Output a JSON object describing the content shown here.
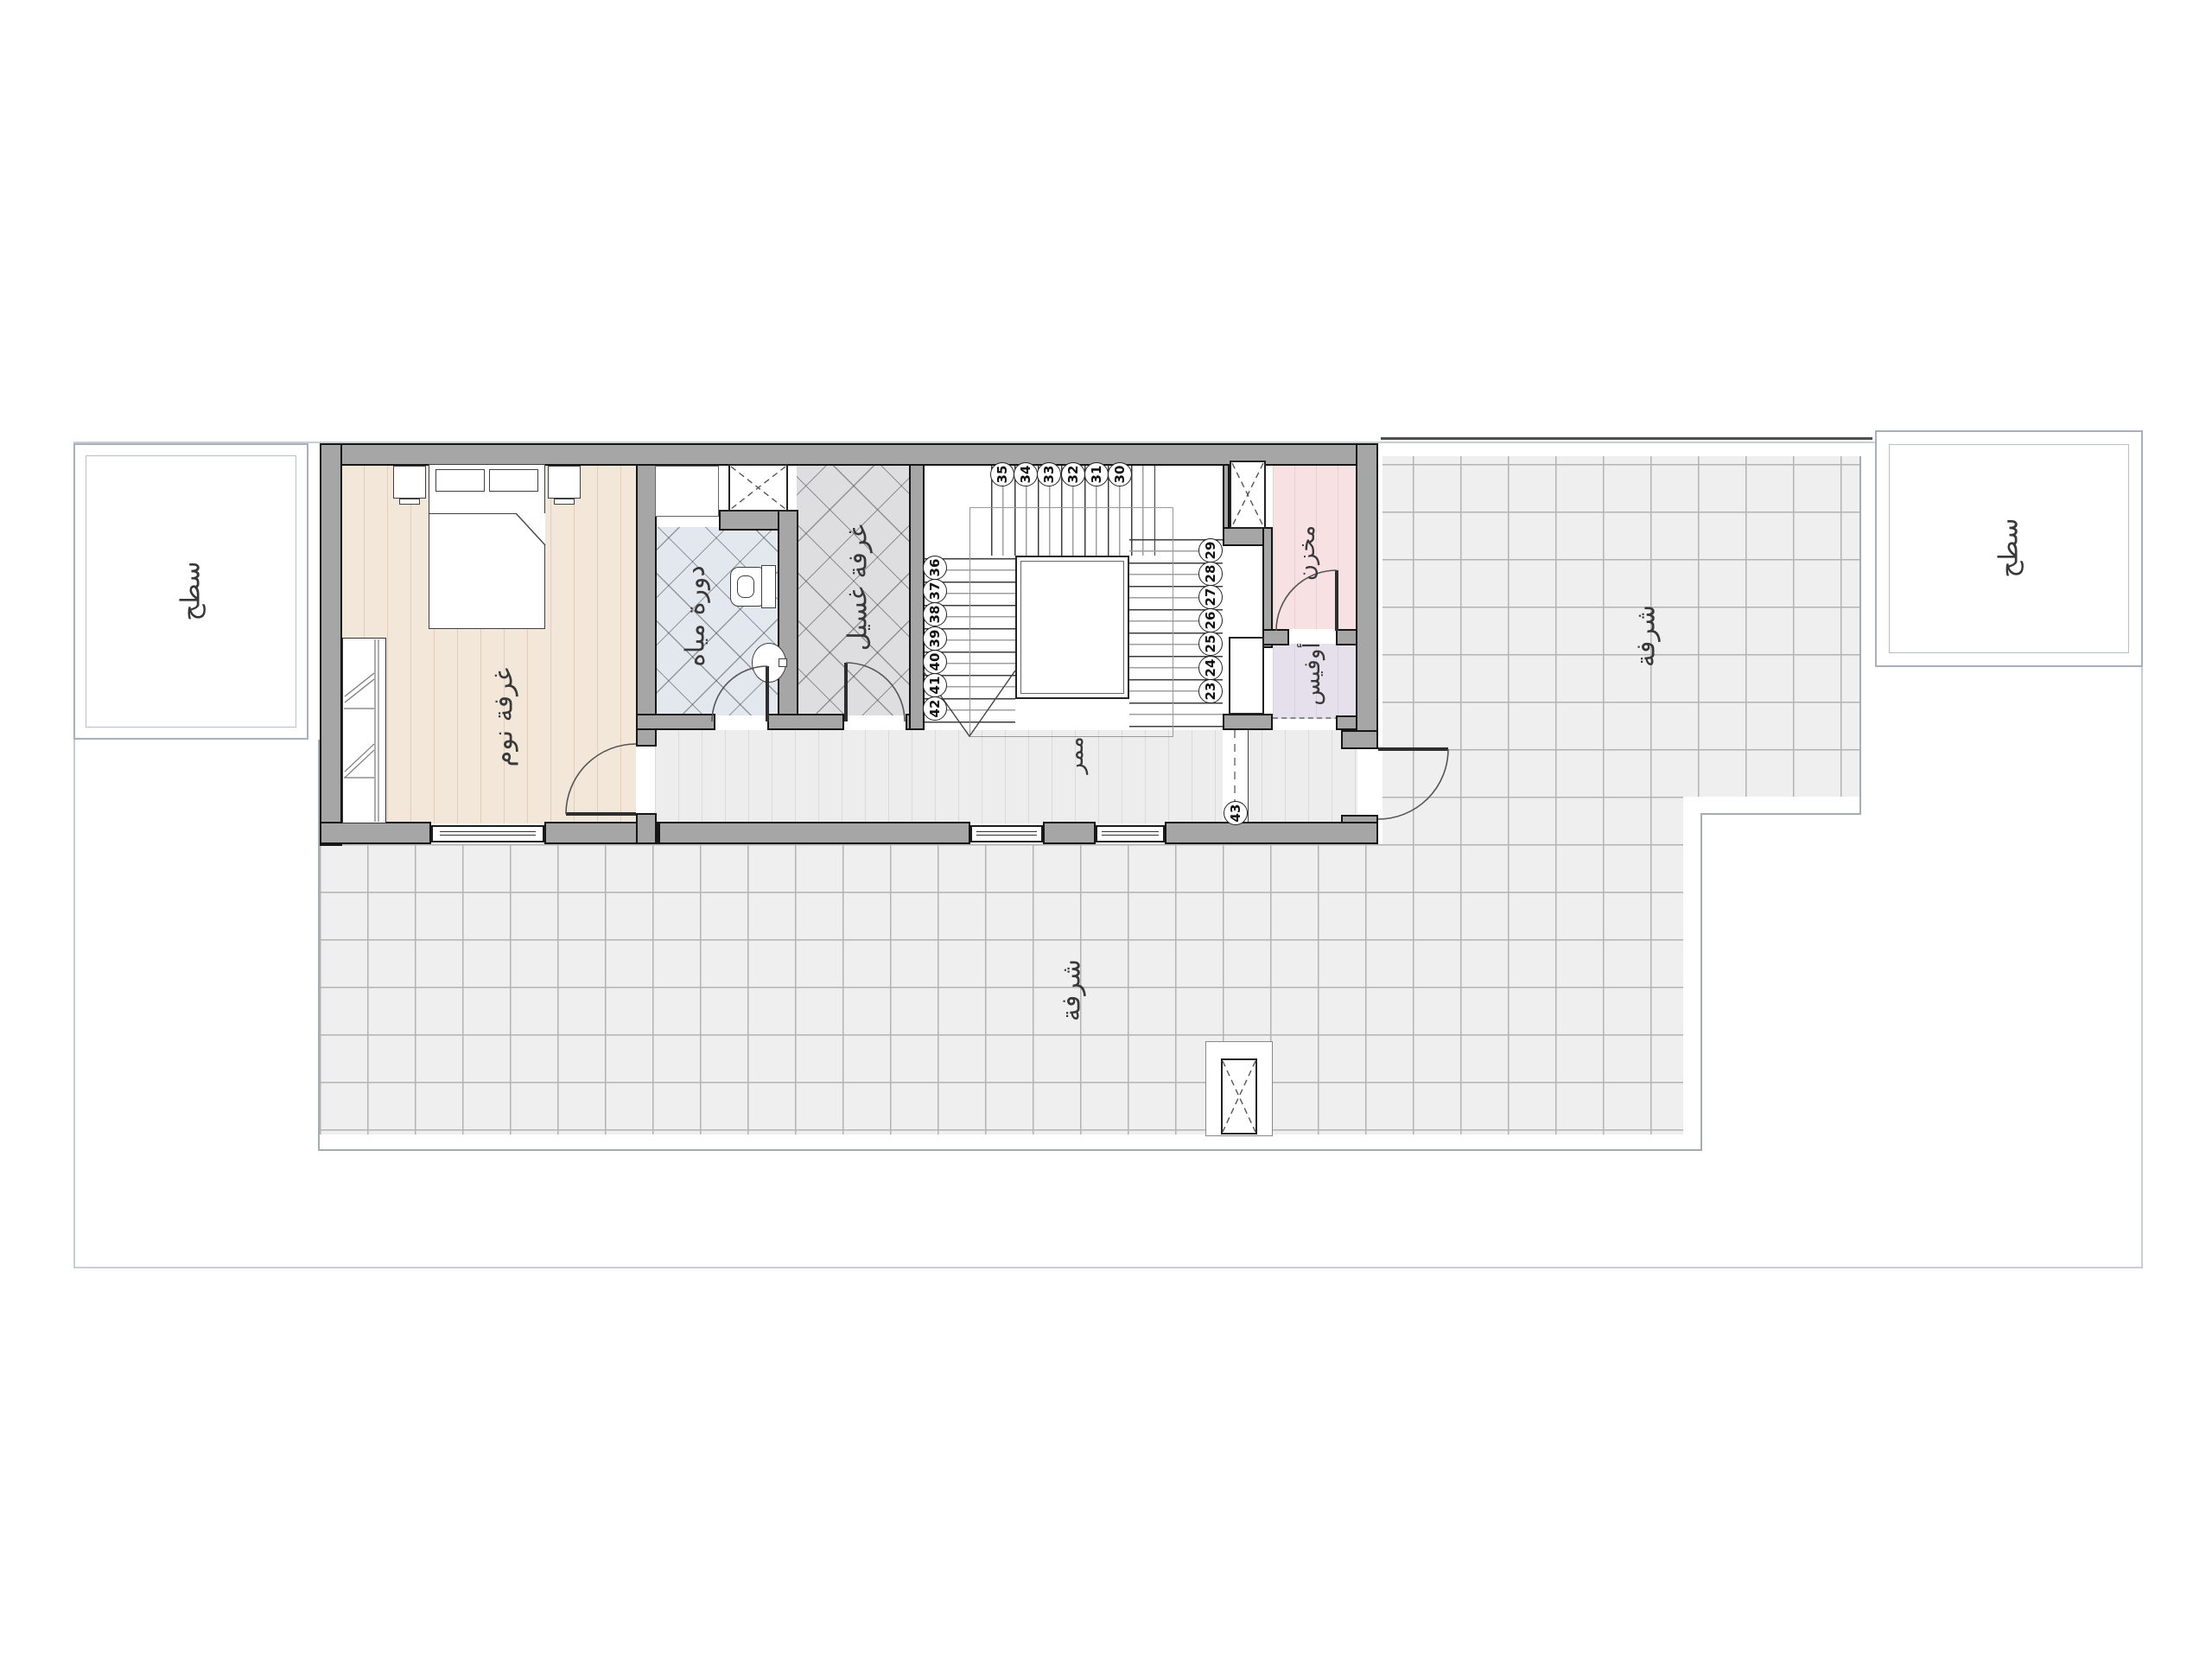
{
  "plan": {
    "type": "residential-roof-floor-plan",
    "labels": {
      "bedroom": "غرفة نوم",
      "bathroom": "دورة مياه",
      "laundry": "غرفة غسيل",
      "storage": "مخزن",
      "office": "أوفيس",
      "corridor": "ممر",
      "balcony_bottom": "شرفة",
      "balcony_right": "شرفة",
      "roof_left": "سطح",
      "roof_right": "سطح"
    },
    "stairs": {
      "top_row": [
        "35",
        "34",
        "33",
        "32",
        "31",
        "30"
      ],
      "left_col": [
        "36",
        "37",
        "38",
        "39",
        "40",
        "41",
        "42"
      ],
      "right_col": [
        "29",
        "28",
        "27",
        "26",
        "25",
        "24",
        "23"
      ],
      "landing_step": "43"
    },
    "colors": {
      "wall_fill": "#a6a6a6",
      "bedroom_floor": "#f3e7da",
      "bathroom_floor": "#e3e8ef",
      "laundry_floor": "#dedee0",
      "corridor_floor": "#ededee",
      "storage_floor": "#f8e1e3",
      "office_floor": "#e6e0ed",
      "balcony_tile": "#efefef"
    }
  }
}
